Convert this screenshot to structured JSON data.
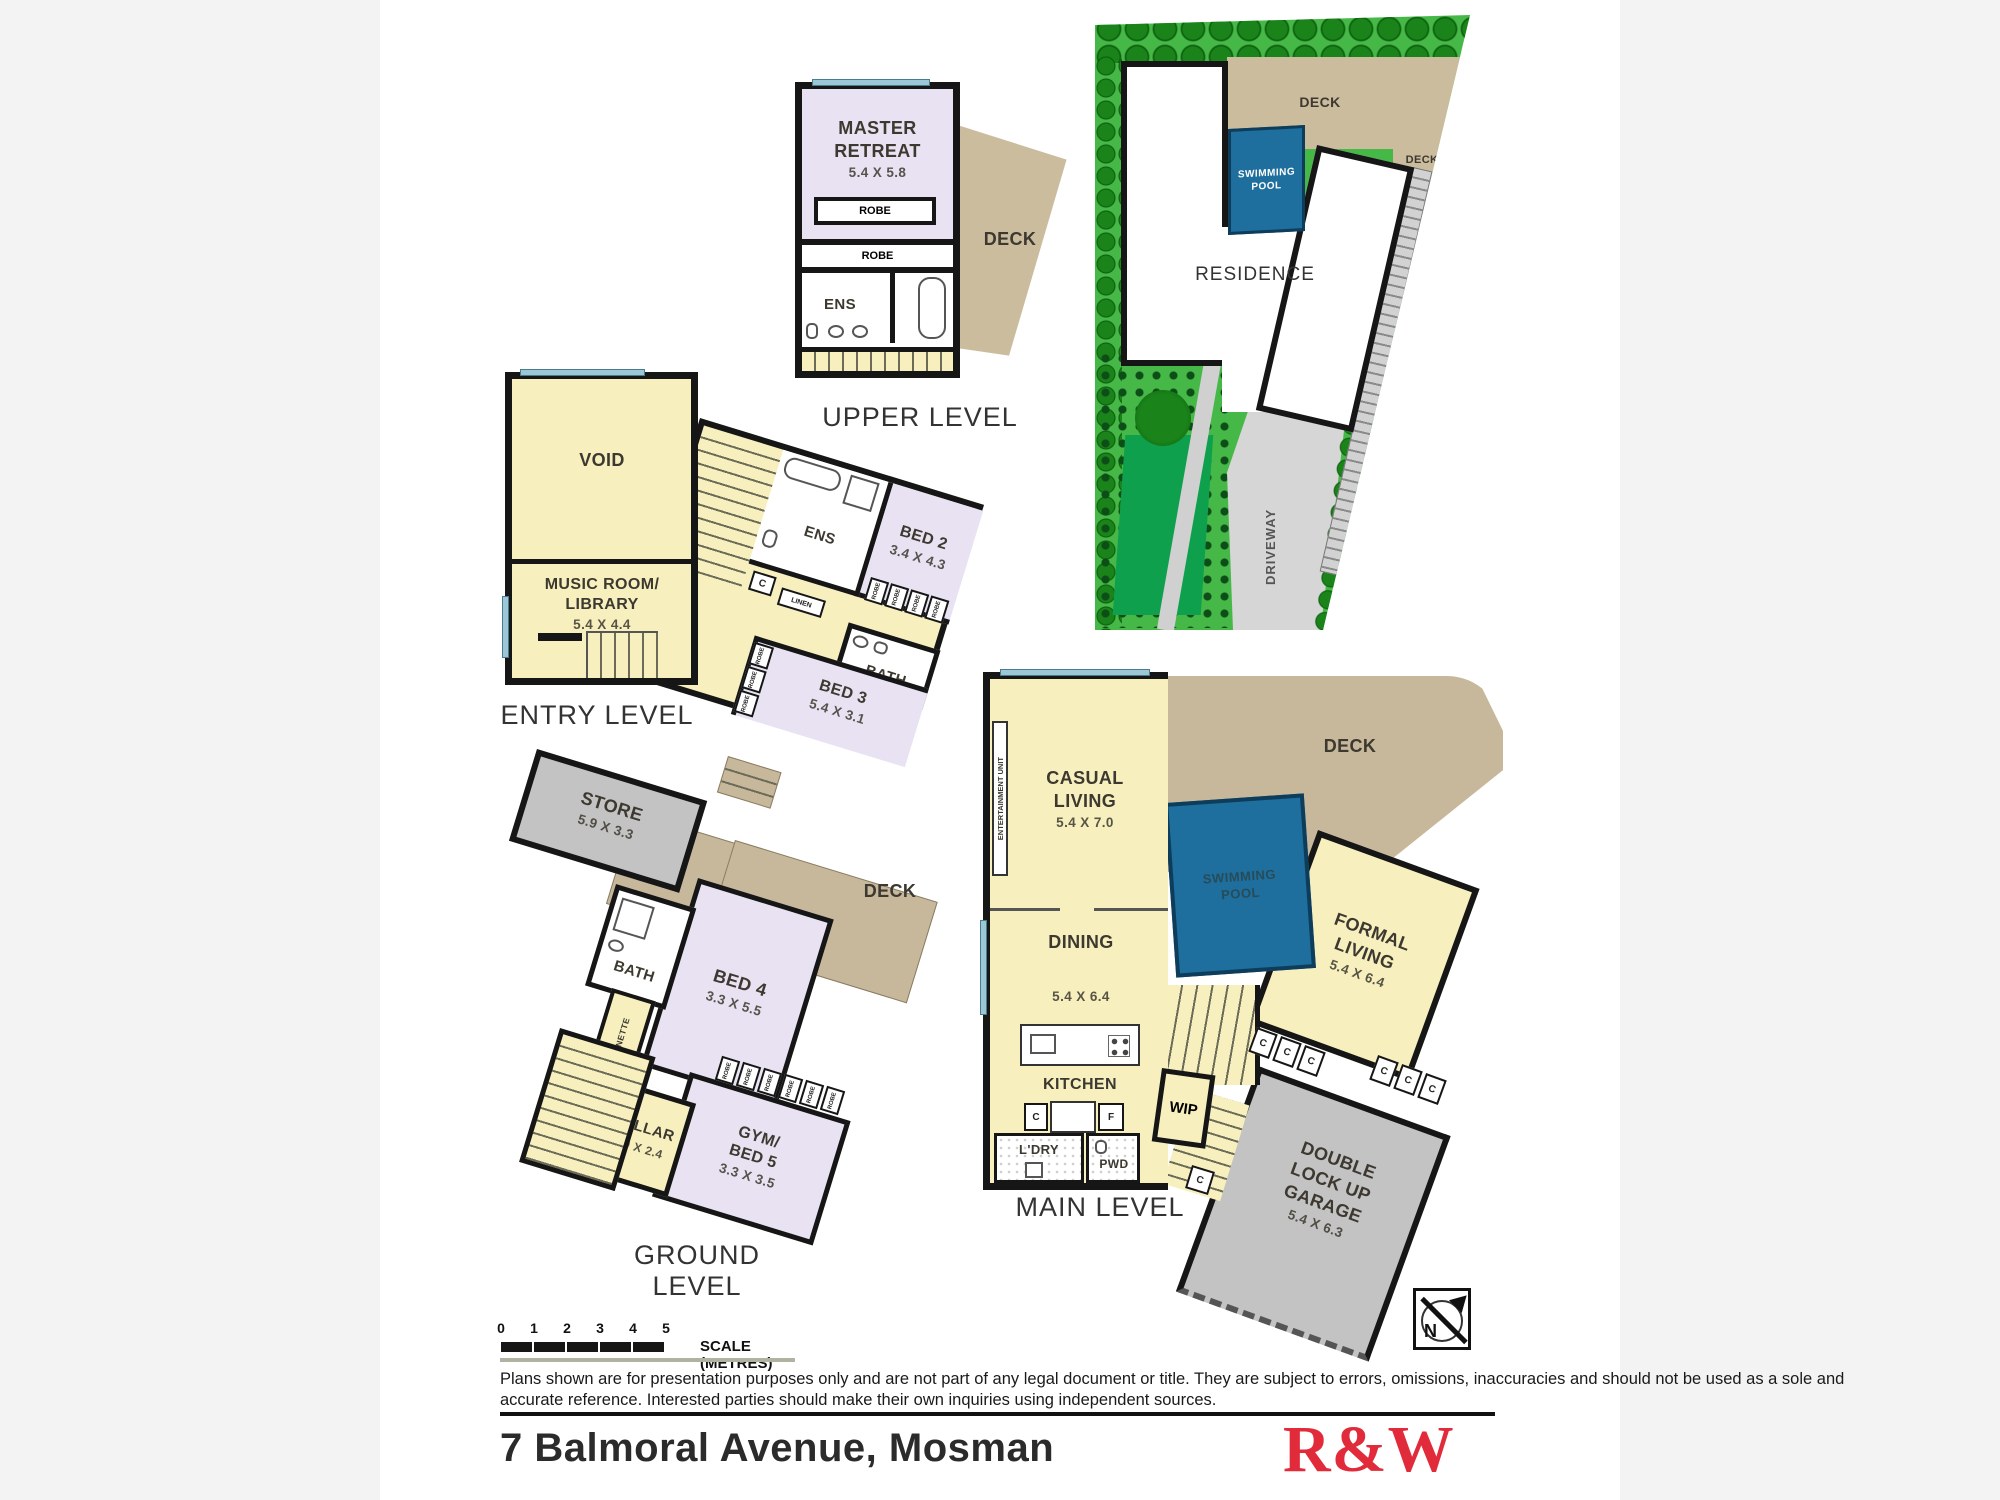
{
  "upper": {
    "title": "UPPER LEVEL",
    "master_name": "MASTER RETREAT",
    "master_dim": "5.4 X 5.8",
    "robe": "ROBE",
    "ens": "ENS",
    "deck": "DECK"
  },
  "site": {
    "residence": "RESIDENCE",
    "deck": "DECK",
    "pool1": "SWIMMING",
    "pool2": "POOL",
    "driveway": "DRIVEWAY"
  },
  "entry": {
    "title": "ENTRY LEVEL",
    "void": "VOID",
    "music1": "MUSIC ROOM/",
    "music2": "LIBRARY",
    "music_dim": "5.4 X 4.4",
    "ens": "ENS",
    "bed2_name": "BED 2",
    "bed2_dim": "3.4 X 4.3",
    "bed3_name": "BED 3",
    "bed3_dim": "5.4 X 3.1",
    "bath": "BATH",
    "linen": "LINEN",
    "c": "C",
    "robe": "ROBE"
  },
  "ground": {
    "title": "GROUND LEVEL",
    "store_name": "STORE",
    "store_dim": "5.9 X 3.3",
    "deck": "DECK",
    "bath": "BATH",
    "kitchenette": "KITCHENETTE",
    "bed4_name": "BED 4",
    "bed4_dim": "3.3 X 5.5",
    "cellar_name": "CELLAR",
    "cellar_dim": "1.9 X 2.4",
    "gym1": "GYM/",
    "gym2": "BED 5",
    "gym_dim": "3.3 X 3.5",
    "robe": "ROBE"
  },
  "main": {
    "title": "MAIN LEVEL",
    "entertainment": "ENTERTAINMENT UNIT",
    "casual1": "CASUAL",
    "casual2": "LIVING",
    "casual_dim": "5.4 X 7.0",
    "deck": "DECK",
    "pool1": "SWIMMING",
    "pool2": "POOL",
    "formal1": "FORMAL",
    "formal2": "LIVING",
    "formal_dim": "5.4 X 6.4",
    "dining": "DINING",
    "dining_dim": "5.4 X 6.4",
    "kitchen": "KITCHEN",
    "wip": "WIP",
    "ldry": "L'DRY",
    "pwd": "PWD",
    "c": "C",
    "f": "F",
    "garage1": "DOUBLE",
    "garage2": "LOCK UP",
    "garage3": "GARAGE",
    "garage_dim": "5.4 X 6.3",
    "north": "N"
  },
  "footer": {
    "scale_ticks": [
      "0",
      "1",
      "2",
      "3",
      "4",
      "5"
    ],
    "scale_label": "SCALE (METRES)",
    "disclaimer1": "Plans shown are for presentation purposes only and are not part of any legal document or title. They are subject to errors, omissions, inaccuracies and should not be used as a sole and",
    "disclaimer2": "accurate reference. Interested parties should make their own inquiries using independent sources.",
    "address": "7 Balmoral Avenue, Mosman",
    "brand": "R&W"
  },
  "colors": {
    "pool_blue": "#1E6E9E",
    "garden_green": "#46B848",
    "lawn_green": "#0FA04D",
    "deck_tan": "#C7B89B",
    "brand_red": "#E12B3B"
  }
}
